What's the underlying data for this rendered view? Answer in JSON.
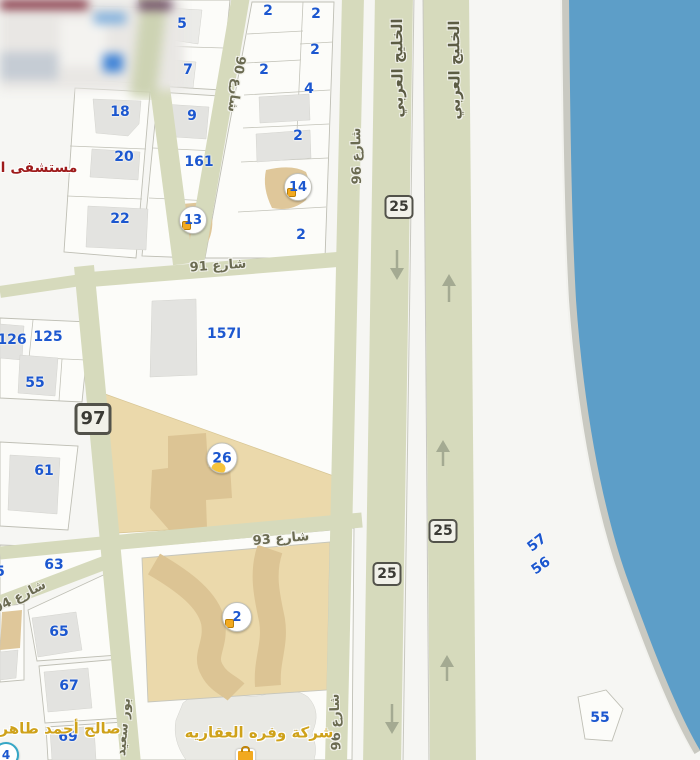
{
  "map": {
    "parcel_numbers": [
      "5",
      "7",
      "2",
      "2",
      "2",
      "2",
      "4",
      "18",
      "9",
      "20",
      "161",
      "2",
      "22",
      "2",
      "126",
      "125",
      "55",
      "61",
      "157ا",
      "63",
      "5",
      "65",
      "67",
      "69",
      "57",
      "56",
      "55"
    ],
    "street_labels": [
      {
        "name": "street-90",
        "text": "شارع 90"
      },
      {
        "name": "street-96-top",
        "text": "شارع 96"
      },
      {
        "name": "street-96-bottom",
        "text": "شارع 96"
      },
      {
        "name": "khaleej-al-arabi-left",
        "text": "الخليج العربي"
      },
      {
        "name": "khaleej-al-arabi-right",
        "text": "الخليج العربي"
      },
      {
        "name": "street-91",
        "text": "شارع 91"
      },
      {
        "name": "street-93",
        "text": "شارع 93"
      },
      {
        "name": "street-94",
        "text": "شارع 94"
      },
      {
        "name": "port-said-street",
        "text": "بور سعيد"
      }
    ],
    "route_badges": [
      "97",
      "25",
      "25",
      "25"
    ],
    "markers": [
      "13",
      "14",
      "26",
      "2",
      "4"
    ],
    "pois": {
      "hospital": "مستشفى ال",
      "person_name": "صالح أحمد طاهر",
      "company_name": "شركة وفره العقاريه"
    },
    "icons": {
      "marker_glyph": "shopping-bag-icon",
      "road_arrow": "direction-arrow-icon"
    },
    "colors": {
      "water": "#5d9ec8",
      "road_olive": "#d6dabc",
      "parcel_tan": "#ebd9ab",
      "building_tan": "#dcc494",
      "building_gray": "#e3e3e0",
      "parcel_number_blue": "#1c57cf",
      "street_label_olive": "#6b6b52",
      "poi_yellow": "#cfa21a",
      "hospital_red": "#9e1b1b",
      "badge_border": "#52524a"
    }
  }
}
